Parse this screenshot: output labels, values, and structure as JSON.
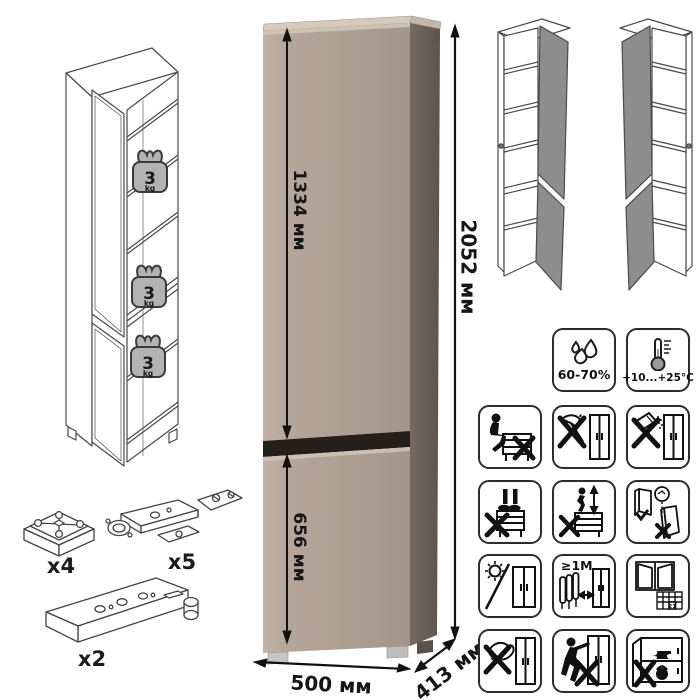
{
  "cabinet": {
    "upper_door_height": "1334 мм",
    "lower_door_height": "656 мм",
    "total_height": "2052 мм",
    "width": "500 мм",
    "depth": "413 мм"
  },
  "shelf_load": {
    "value": "3",
    "unit": "kg"
  },
  "hardware": {
    "foot_qty": "x4",
    "hinge_qty": "x5",
    "rail_qty": "x2"
  },
  "conditions": {
    "humidity": "60-70%",
    "temperature": "+10...+25°C"
  },
  "warnings": {
    "heater_distance": "≥1М",
    "calendar_day": "21",
    "icons": [
      "no-sitting",
      "no-sharp-tools",
      "no-abrasive-powder",
      "no-standing",
      "no-jumping",
      "door-adjustment",
      "no-direct-sunlight",
      "keep-1m-from-heater",
      "ventilate-room",
      "no-wet-sponge",
      "no-dragging",
      "no-overloading"
    ]
  },
  "colors": {
    "front": "#b2a396",
    "side": "#6a6057",
    "top": "#d6cabd",
    "gap": "#241f1b",
    "door_panel": "#8d8d8d",
    "weight_fill": "#b3b3b3"
  }
}
